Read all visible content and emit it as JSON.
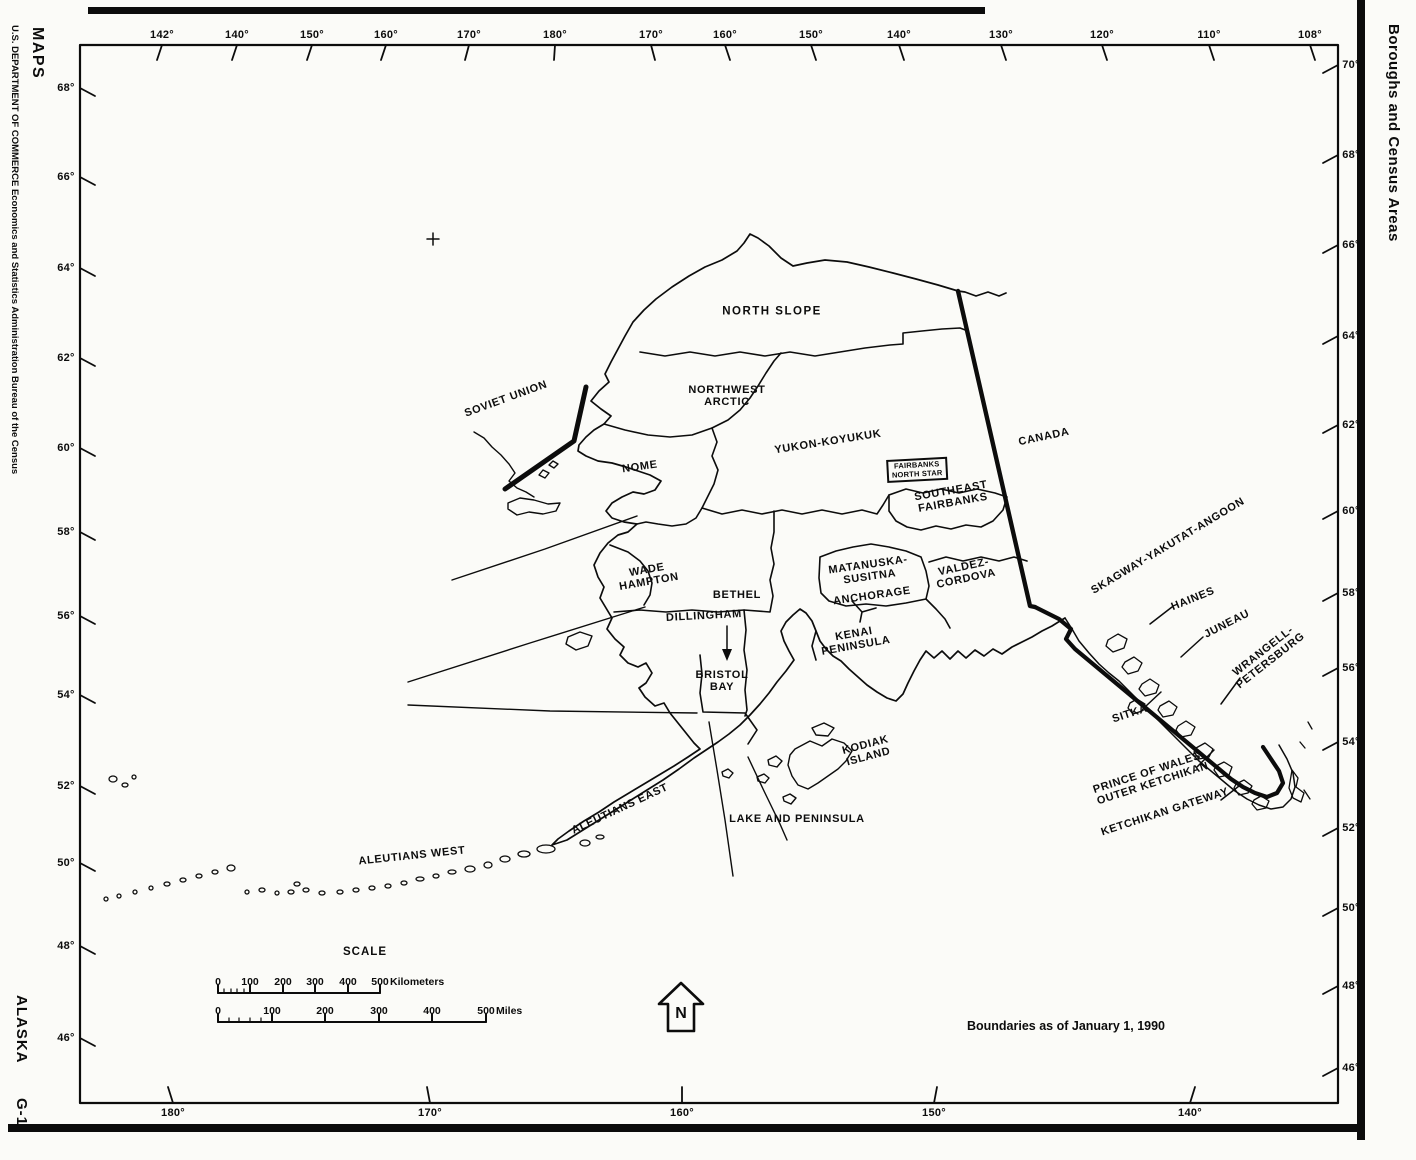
{
  "margins": {
    "publisher_line": "U.S. DEPARTMENT OF COMMERCE   Economics and Statistics Administration   Bureau of the Census",
    "series": "MAPS",
    "state": "ALASKA",
    "sheet": "G-1",
    "right_title": "Boroughs and Census Areas"
  },
  "map": {
    "note": "Boundaries as of January 1, 1990",
    "north_arrow": "N",
    "countries": {
      "soviet_union": "SOVIET UNION",
      "canada": "CANADA"
    },
    "regions": {
      "north_slope": "NORTH SLOPE",
      "northwest_arctic": "NORTHWEST\nARCTIC",
      "yukon_koyukuk": "YUKON-KOYUKUK",
      "nome": "NOME",
      "fairbanks_north_star": "FAIRBANKS\nNORTH STAR",
      "southeast_fairbanks": "SOUTHEAST\nFAIRBANKS",
      "wade_hampton": "WADE\nHAMPTON",
      "matanuska_susitna": "MATANUSKA-\nSUSITNA",
      "anchorage": "ANCHORAGE",
      "valdez_cordova": "VALDEZ-\nCORDOVA",
      "bethel": "BETHEL",
      "dillingham": "DILLINGHAM",
      "kenai_peninsula": "KENAI\nPENINSULA",
      "bristol_bay": "BRISTOL\nBAY",
      "kodiak_island": "KODIAK\nISLAND",
      "lake_and_peninsula": "LAKE AND PENINSULA",
      "aleutians_east": "ALEUTIANS EAST",
      "aleutians_west": "ALEUTIANS WEST",
      "skagway_yakutat_angoon": "SKAGWAY-YAKUTAT-ANGOON",
      "haines": "HAINES",
      "juneau": "JUNEAU",
      "wrangell_petersburg": "WRANGELL-\nPETERSBURG",
      "sitka": "SITKA",
      "prince_of_wales_outer_ketchikan": "PRINCE OF WALES-\nOUTER KETCHIKAN",
      "ketchikan_gateway": "KETCHIKAN GATEWAY"
    },
    "scale": {
      "title": "SCALE",
      "km_ticks": [
        "0",
        "100",
        "200",
        "300",
        "400",
        "500"
      ],
      "km_unit": "Kilometers",
      "mi_ticks": [
        "0",
        "100",
        "200",
        "300",
        "400",
        "500"
      ],
      "mi_unit": "Miles"
    }
  },
  "graticule": {
    "top": [
      "142°",
      "140°",
      "150°",
      "160°",
      "170°",
      "180°",
      "170°",
      "160°",
      "150°",
      "140°",
      "130°",
      "120°",
      "110°",
      "108°"
    ],
    "left": [
      "68°",
      "66°",
      "64°",
      "62°",
      "60°",
      "58°",
      "56°",
      "54°",
      "52°",
      "50°",
      "48°",
      "46°"
    ],
    "right": [
      "70°",
      "68°",
      "66°",
      "64°",
      "62°",
      "60°",
      "58°",
      "56°",
      "54°",
      "52°",
      "50°",
      "48°",
      "46°"
    ],
    "bottom": [
      "180°",
      "170°",
      "160°",
      "150°",
      "140°"
    ]
  },
  "colors": {
    "ink": "#0c0c0c",
    "paper": "#fbfbf8"
  }
}
